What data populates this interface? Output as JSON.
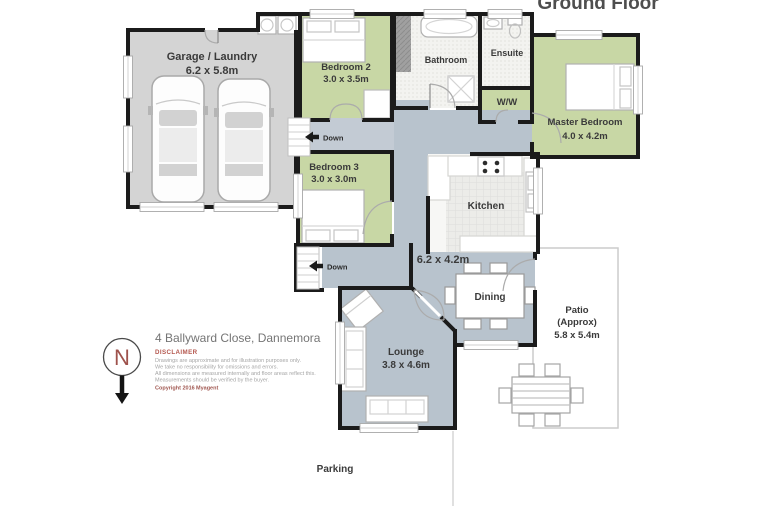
{
  "title": "Ground Floor",
  "address": "4 Ballyward Close, Dannemora",
  "compass": {
    "label": "N"
  },
  "stairs": {
    "down_label": "Down"
  },
  "rooms": {
    "garage": {
      "name": "Garage / Laundry",
      "dims": "6.2 x 5.8m"
    },
    "bedroom2": {
      "name": "Bedroom 2",
      "dims": "3.0 x 3.5m"
    },
    "bathroom": {
      "name": "Bathroom"
    },
    "ensuite": {
      "name": "Ensuite"
    },
    "wardrobe": {
      "name": "W/W"
    },
    "master_bedroom": {
      "name": "Master Bedroom",
      "dims": "4.0 x 4.2m"
    },
    "bedroom3": {
      "name": "Bedroom 3",
      "dims": "3.0 x 3.0m"
    },
    "kitchen": {
      "name": "Kitchen"
    },
    "kitchen_dining": {
      "dims": "6.2 x 4.2m"
    },
    "dining": {
      "name": "Dining"
    },
    "lounge": {
      "name": "Lounge",
      "dims": "3.8 x 4.6m"
    },
    "patio": {
      "name": "Patio",
      "qualifier": "(Approx)",
      "dims": "5.8 x 5.4m"
    },
    "parking": {
      "name": "Parking"
    }
  },
  "disclaimer": {
    "heading": "DISCLAIMER",
    "lines": [
      "Drawings are approximate and for illustration purposes only.",
      "We take no responsibility for omissions and errors.",
      "All dimensions are measured internally and floor areas reflect this.",
      "Measurements should be verified by the buyer."
    ],
    "copyright": "Copyright 2016",
    "agency": "Myagent"
  },
  "colors": {
    "bedroom_green": "#c8d7a5",
    "living_blue_gray": "#b8c3cd",
    "garage_gray": "#d4d4d4",
    "wall_black": "#1b1b1b",
    "disclaimer_red": "#b4574e",
    "patio_border": "#cccccc"
  }
}
